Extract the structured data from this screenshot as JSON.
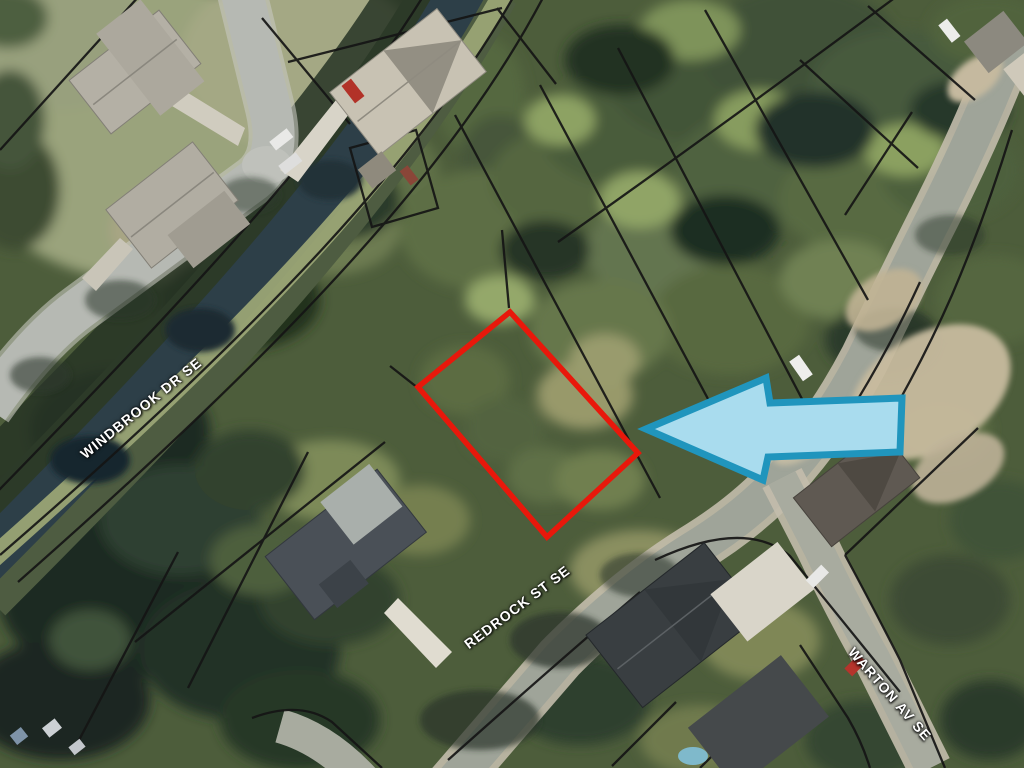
{
  "streets": {
    "windbrook": {
      "label": "WINDBROOK DR SE"
    },
    "redrock": {
      "label": "REDROCK ST SE"
    },
    "warton": {
      "label": "WARTON AV SE"
    }
  },
  "annotations": {
    "lot_outline": {
      "color": "#e8180b"
    },
    "arrow": {
      "fill": "#a9dcee",
      "border": "#2095bd",
      "direction": "left"
    }
  },
  "label_style": {
    "color": "#ffffff"
  }
}
